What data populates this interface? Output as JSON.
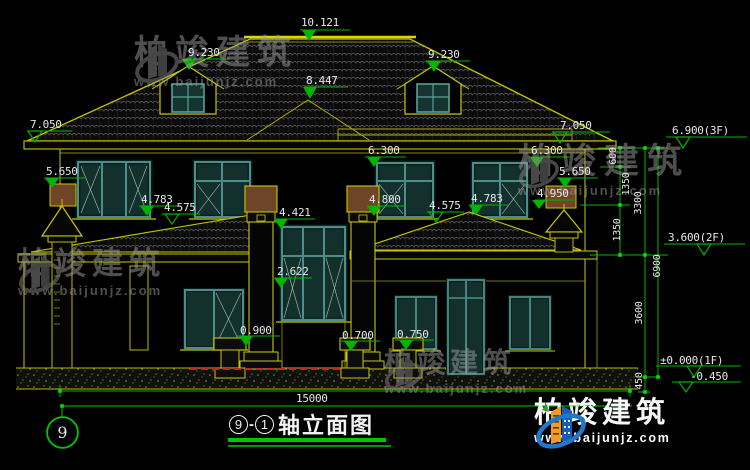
{
  "title_block": {
    "axis_start": "9",
    "separator": "-",
    "axis_end": "1",
    "name": "轴立面图"
  },
  "grid_bubble": {
    "label": "9"
  },
  "markers": [
    {
      "label": "10.121"
    },
    {
      "label": "9.230"
    },
    {
      "label": "9.230"
    },
    {
      "label": "8.447"
    },
    {
      "label": "7.050"
    },
    {
      "label": "7.050"
    },
    {
      "label": "6.900(3F)"
    },
    {
      "label": "6.300"
    },
    {
      "label": "6.300"
    },
    {
      "label": "5.650"
    },
    {
      "label": "5.650"
    },
    {
      "label": "4.783"
    },
    {
      "label": "4.575"
    },
    {
      "label": "4.421"
    },
    {
      "label": "4.800"
    },
    {
      "label": "4.575"
    },
    {
      "label": "4.783"
    },
    {
      "label": "4.950"
    },
    {
      "label": "2.622"
    },
    {
      "label": "0.900"
    },
    {
      "label": "0.700"
    },
    {
      "label": "0.750"
    },
    {
      "label": "3.600(2F)"
    },
    {
      "label": "±0.000(1F)"
    },
    {
      "label": "-0.450"
    }
  ],
  "dims": {
    "v600": "600",
    "v1350a": "1350",
    "v1350b": "1350",
    "v3300": "3300",
    "v3600": "3600",
    "v450": "450",
    "v6900": "6900",
    "h15000": "15000"
  },
  "watermark": {
    "brand": "柏竣建筑",
    "site": "www.baijunjz.com"
  },
  "logo": {
    "brand": "柏竣建筑",
    "site": "www.baijunjz.com"
  },
  "colors": {
    "cad_yellow": "#c8c800",
    "cad_green": "#00b400",
    "window_teal": "#4e8e8a",
    "capital_brown": "#6e4526",
    "hidden_red": "#cc2222",
    "logo_blue": "#1e78cc",
    "logo_orange": "#f59a23",
    "watermark_gray": "#9d9d9d"
  }
}
